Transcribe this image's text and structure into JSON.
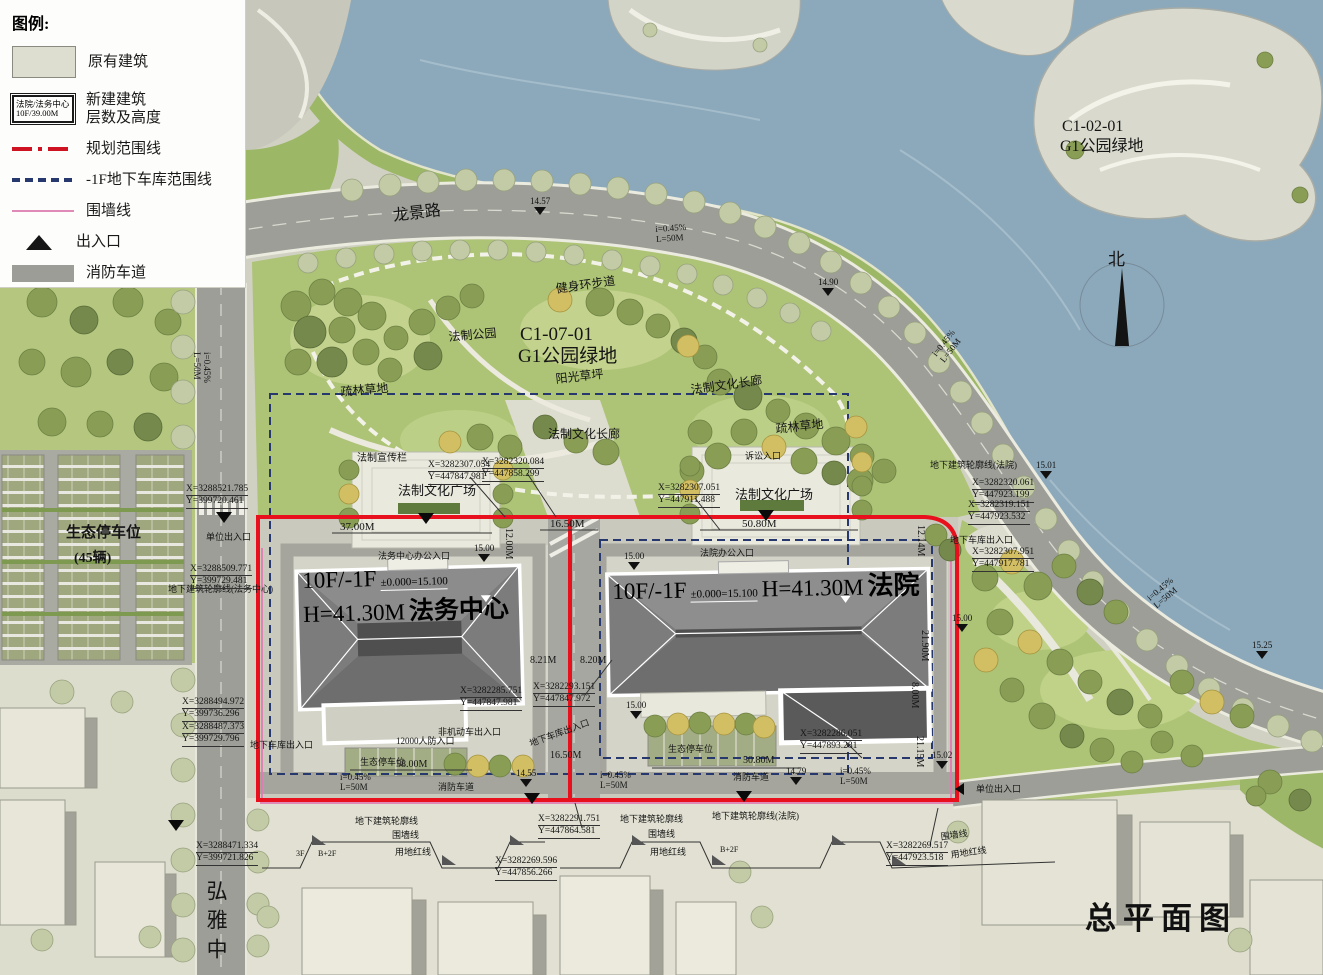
{
  "colors": {
    "planning_boundary": "#e8101c",
    "garage_boundary": "#26386d",
    "wall_line": "#e07cb2",
    "water": "#8ca9bb",
    "park_green": "#adc375",
    "road_gray": "#9c9e97",
    "roof_dark": "#4f4f4f"
  },
  "title": "总平面图",
  "north": "北",
  "legend": {
    "title": "图例:",
    "existing": "原有建筑",
    "new_swatch_line1": "法院/法务中心",
    "new_swatch_line2": "10F/39.00M",
    "new_line1": "新建建筑",
    "new_line2": "层数及高度",
    "planning_boundary": "规划范围线",
    "garage_boundary": "-1F地下车库范围线",
    "wall": "围墙线",
    "entrance": "出入口",
    "fire_lane": "消防车道"
  },
  "buildings": {
    "legal_center": {
      "floors": "10F/-1F",
      "height": "H=41.30M",
      "level": "±0.000=15.100",
      "name": "法务中心"
    },
    "court": {
      "floors": "10F/-1F",
      "height": "H=41.30M",
      "level": "±0.000=15.100",
      "name": "法院"
    }
  },
  "zones": {
    "park_code": "C1-07-01",
    "park_name": "G1公园绿地",
    "island_code": "C1-02-01",
    "island_name": "G1公园绿地",
    "eco_parking": "生态停车位",
    "eco_parking_count": "(45辆)"
  },
  "roads": {
    "longjing": "龙景路",
    "hongya": "弘雅中"
  },
  "labels": {
    "fitness_trail": "健身环步道",
    "law_park": "法制公园",
    "sunny_lawn": "阳光草坪",
    "culture_corridor": "法制文化长廊",
    "sparse_lawn": "疏林草地",
    "bulletin_board": "法制宣传栏",
    "culture_plaza": "法制文化广场",
    "center_office_entrance": "法务中心办公入口",
    "court_office_entrance": "法院办公入口",
    "litigation_entrance": "诉讼入口",
    "unit_entrance": "单位出入口",
    "garage_entrance": "地下车库出入口",
    "non_motor_entrance": "非机动车出入口",
    "civil_defense_entrance": "12000人防入口",
    "p_parking": "生态停车位",
    "fire_lane": "消防车道",
    "underground_outline_center": "地下建筑轮廓线(法务中心)",
    "underground_outline_court": "地下建筑轮廓线(法院)",
    "underground_outline": "地下建筑轮廓线",
    "wall_line": "围墙线",
    "red_line": "用地红线",
    "bldg_3f": "3F",
    "bldg_b2f": "B+2F"
  },
  "dims": {
    "d37": "37.00M",
    "d1650": "16.50M",
    "d5080": "50.80M",
    "d1214": "12.14M",
    "d1200": "12.00M",
    "d821": "8.21M",
    "d820": "8.20M",
    "d2190": "21.90M",
    "d800": "8.00M",
    "d2115": "21.15M",
    "d5800": "58.00M"
  },
  "slopes": {
    "grade": "i=0.45%",
    "length": "L=50M"
  },
  "elevations": {
    "e1457": "14.57",
    "e1490": "14.90",
    "e1501": "15.01",
    "e1525": "15.25",
    "e1455": "14.55",
    "e1479": "14.79",
    "e1500": "15.00",
    "e1502": "15.02"
  },
  "coords": {
    "p1": {
      "x": "X=3288521.785",
      "y": "Y=399720.461"
    },
    "p2": {
      "x": "X=3288509.771",
      "y": "Y=399729.481"
    },
    "p3": {
      "x": "X=3288494.972",
      "y": "Y=399736.296"
    },
    "p4": {
      "x": "X=3288487.373",
      "y": "Y=399729.796"
    },
    "p5": {
      "x": "X=3288471.334",
      "y": "Y=399721.826"
    },
    "p6": {
      "x": "X=3282307.054",
      "y": "Y=447847.981"
    },
    "p7": {
      "x": "X=3282320.084",
      "y": "Y=447858.299"
    },
    "p8": {
      "x": "X=3282307.051",
      "y": "Y=447911.488"
    },
    "p9": {
      "x": "X=3282285.751",
      "y": "Y=447847.981"
    },
    "p10": {
      "x": "X=3282293.151",
      "y": "Y=447847.972"
    },
    "p11": {
      "x": "X=3282286.051",
      "y": "Y=447893.281"
    },
    "p12": {
      "x": "X=3282291.751",
      "y": "Y=447864.581"
    },
    "p13": {
      "x": "X=3282269.596",
      "y": "Y=447856.266"
    },
    "p14": {
      "x": "X=3282269.517",
      "y": "Y=447923.518"
    },
    "p15": {
      "x": "X=3282320.061",
      "y": "Y=447923.199"
    },
    "p16": {
      "x": "X=3282319.151",
      "y": "Y=447923.532"
    },
    "p17": {
      "x": "X=3282307.951",
      "y": "Y=447917.781"
    }
  }
}
